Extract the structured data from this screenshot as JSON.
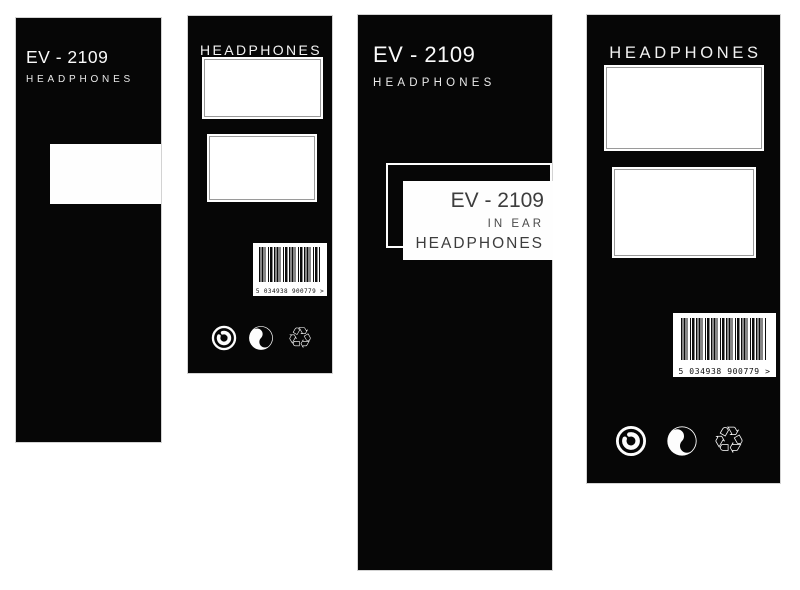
{
  "colors": {
    "panel_bg": "#060606",
    "text_light": "#fafafa",
    "text_dark": "#3d3d3d",
    "frame_line": "#9a9a9a",
    "box_bg": "#fefefe"
  },
  "panels": {
    "p1": {
      "model": "EV - 2109",
      "product": "HEADPHONES"
    },
    "p2": {
      "title": "HEADPHONES",
      "barcode": "5 034938 900779 >"
    },
    "p3": {
      "model": "EV - 2109",
      "product": "HEADPHONES",
      "card": {
        "model": "EV - 2109",
        "variant": "IN EAR",
        "product": "HEADPHONES"
      }
    },
    "p4": {
      "title": "HEADPHONES",
      "barcode": "5 034938 900779 >"
    }
  },
  "icons": {
    "recycle_glyph": "♲",
    "names": [
      "copyright-c-icon",
      "green-dot-icon",
      "recycling-icon"
    ]
  }
}
